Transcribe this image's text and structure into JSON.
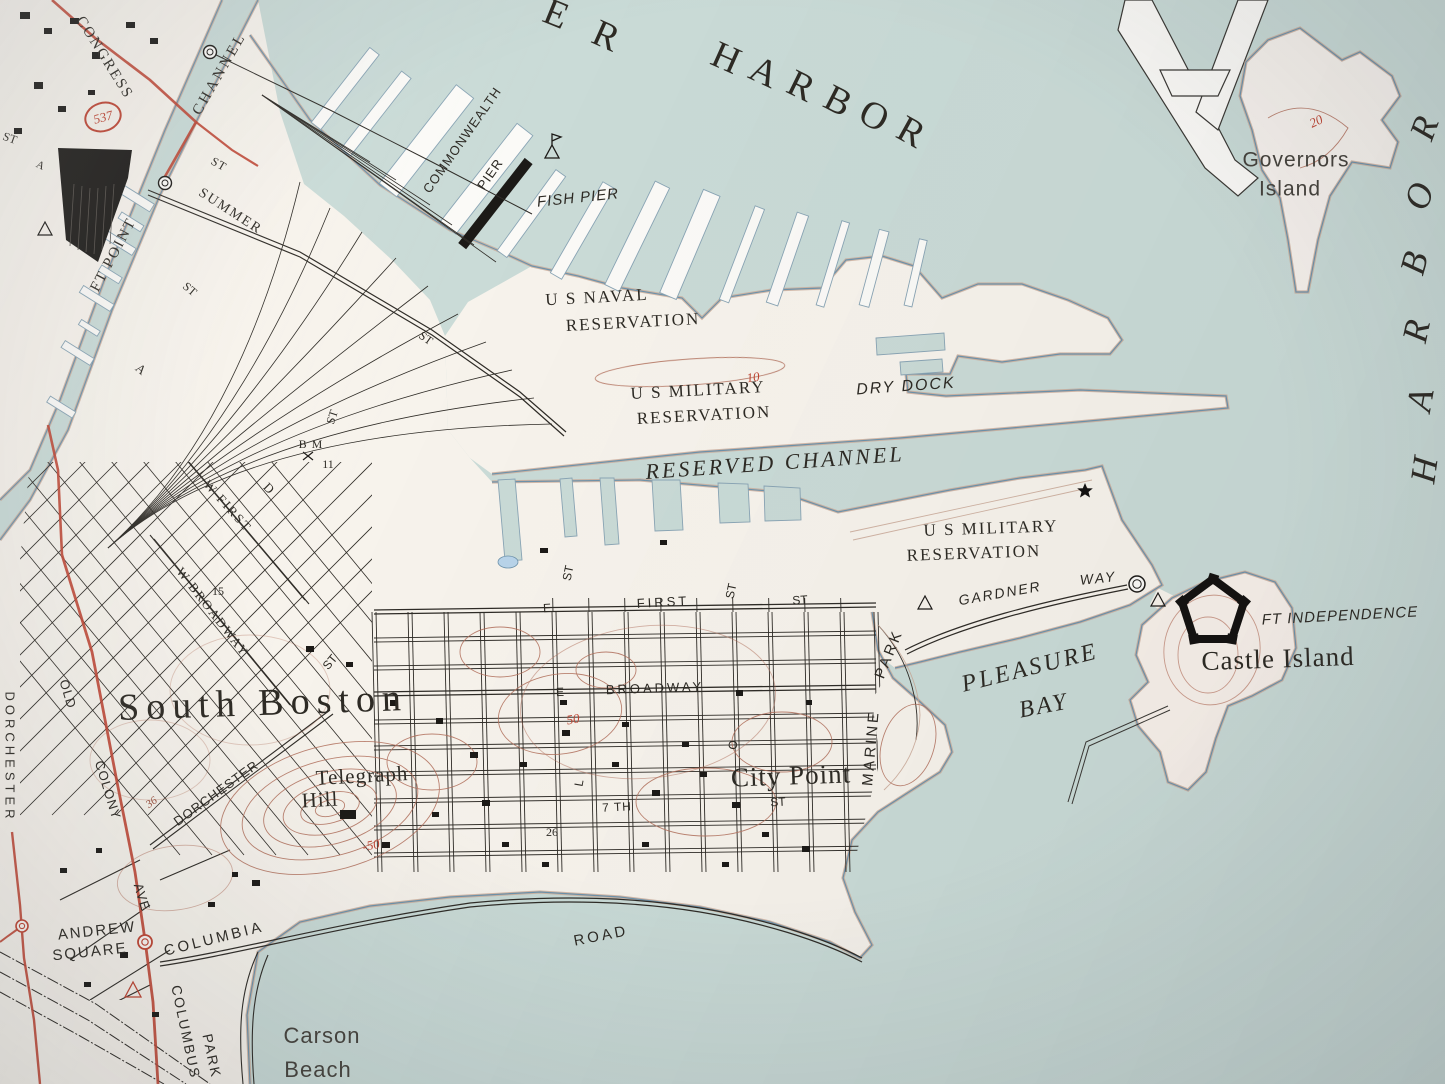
{
  "map": {
    "colors": {
      "water": "#cadbd7",
      "land": "#f7f3ec",
      "pier": "#fbfaf7",
      "road_red": "#bf4533",
      "contour": "#b2705c",
      "shore_blue": "#6f93ab",
      "shore_tan": "#cbab99",
      "ink": "#2f2c27"
    },
    "labels": [
      {
        "t": "E",
        "x": 556,
        "y": 14,
        "r": 22,
        "c": "serif",
        "s": 38,
        "ls": 0,
        "n": "label-harbor-arc"
      },
      {
        "t": "R",
        "x": 606,
        "y": 36,
        "r": 24,
        "c": "serif",
        "s": 38,
        "ls": 0,
        "n": "label-harbor-arc"
      },
      {
        "t": "H",
        "x": 726,
        "y": 58,
        "r": 24,
        "c": "serif",
        "s": 38,
        "ls": 0,
        "n": "label-harbor-arc"
      },
      {
        "t": "A",
        "x": 764,
        "y": 72,
        "r": 25,
        "c": "serif",
        "s": 38,
        "ls": 0,
        "n": "label-harbor-arc"
      },
      {
        "t": "R",
        "x": 801,
        "y": 86,
        "r": 26,
        "c": "serif",
        "s": 38,
        "ls": 0,
        "n": "label-harbor-arc"
      },
      {
        "t": "B",
        "x": 838,
        "y": 101,
        "r": 27,
        "c": "serif",
        "s": 38,
        "ls": 0,
        "n": "label-harbor-arc"
      },
      {
        "t": "O",
        "x": 874,
        "y": 116,
        "r": 28,
        "c": "serif",
        "s": 38,
        "ls": 0,
        "n": "label-harbor-arc"
      },
      {
        "t": "R",
        "x": 911,
        "y": 132,
        "r": 29,
        "c": "serif",
        "s": 38,
        "ls": 0,
        "n": "label-harbor-arc"
      },
      {
        "t": "R",
        "x": 1424,
        "y": 128,
        "r": -70,
        "c": "serif-it",
        "s": 36,
        "ls": 0,
        "n": "label-harbor-vertical"
      },
      {
        "t": "O",
        "x": 1419,
        "y": 196,
        "r": -72,
        "c": "serif-it",
        "s": 36,
        "ls": 0,
        "n": "label-harbor-vertical"
      },
      {
        "t": "B",
        "x": 1414,
        "y": 263,
        "r": -75,
        "c": "serif-it",
        "s": 36,
        "ls": 0,
        "n": "label-harbor-vertical"
      },
      {
        "t": "R",
        "x": 1416,
        "y": 331,
        "r": -78,
        "c": "serif-it",
        "s": 36,
        "ls": 0,
        "n": "label-harbor-vertical"
      },
      {
        "t": "A",
        "x": 1420,
        "y": 400,
        "r": -80,
        "c": "serif-it",
        "s": 36,
        "ls": 0,
        "n": "label-harbor-vertical"
      },
      {
        "t": "H",
        "x": 1424,
        "y": 470,
        "r": -82,
        "c": "serif-it",
        "s": 36,
        "ls": 0,
        "n": "label-harbor-vertical"
      },
      {
        "t": "Governors",
        "x": 1296,
        "y": 160,
        "r": 0,
        "c": "thin",
        "s": 21,
        "ls": 1,
        "n": "label-governors-island"
      },
      {
        "t": "Island",
        "x": 1290,
        "y": 189,
        "r": 0,
        "c": "thin",
        "s": 21,
        "ls": 1,
        "n": "label-governors-island"
      },
      {
        "t": "20",
        "x": 1316,
        "y": 121,
        "r": -25,
        "c": "red",
        "s": 13,
        "ls": 0,
        "n": "contour-label-20"
      },
      {
        "t": "CONGRESS",
        "x": 104,
        "y": 58,
        "r": 58,
        "c": "serif",
        "s": 15,
        "ls": 2,
        "n": "label-congress-st"
      },
      {
        "t": "537",
        "x": 103,
        "y": 117,
        "r": -15,
        "c": "red",
        "s": 13,
        "ls": 0,
        "n": "route-marker-537"
      },
      {
        "t": "FT POINT",
        "x": 114,
        "y": 255,
        "r": -62,
        "c": "serif",
        "s": 15,
        "ls": 2,
        "n": "label-ft-point-channel"
      },
      {
        "t": "CHANNEL",
        "x": 220,
        "y": 74,
        "r": -60,
        "c": "serif",
        "s": 15,
        "ls": 3,
        "n": "label-ft-point-channel"
      },
      {
        "t": "ST",
        "x": 219,
        "y": 164,
        "r": 30,
        "c": "serif",
        "s": 12,
        "ls": 1,
        "n": "label-st"
      },
      {
        "t": "SUMMER",
        "x": 230,
        "y": 212,
        "r": 33,
        "c": "serif",
        "s": 14,
        "ls": 2,
        "n": "label-summer-st"
      },
      {
        "t": "COMMONWEALTH",
        "x": 462,
        "y": 140,
        "r": -55,
        "c": "sans",
        "s": 13,
        "ls": 1,
        "n": "label-commonwealth-pier"
      },
      {
        "t": "PIER",
        "x": 490,
        "y": 174,
        "r": -55,
        "c": "sans",
        "s": 13,
        "ls": 1,
        "n": "label-commonwealth-pier"
      },
      {
        "t": "FISH PIER",
        "x": 578,
        "y": 198,
        "r": -6,
        "c": "sans-it",
        "s": 15,
        "ls": 1,
        "n": "label-fish-pier"
      },
      {
        "t": "U S NAVAL",
        "x": 597,
        "y": 297,
        "r": -3,
        "c": "serif",
        "s": 17,
        "ls": 2,
        "n": "label-us-naval-reservation"
      },
      {
        "t": "RESERVATION",
        "x": 633,
        "y": 322,
        "r": -3,
        "c": "serif",
        "s": 17,
        "ls": 2,
        "n": "label-us-naval-reservation"
      },
      {
        "t": "U S MILITARY",
        "x": 698,
        "y": 390,
        "r": -3,
        "c": "serif",
        "s": 17,
        "ls": 2,
        "n": "label-us-military-reservation-1"
      },
      {
        "t": "RESERVATION",
        "x": 704,
        "y": 415,
        "r": -3,
        "c": "serif",
        "s": 17,
        "ls": 2,
        "n": "label-us-military-reservation-1"
      },
      {
        "t": "DRY DOCK",
        "x": 906,
        "y": 387,
        "r": -4,
        "c": "sans-it",
        "s": 16,
        "ls": 2,
        "n": "label-dry-dock"
      },
      {
        "t": "10",
        "x": 753,
        "y": 377,
        "r": -8,
        "c": "red",
        "s": 13,
        "ls": 0,
        "n": "contour-label-10"
      },
      {
        "t": "RESERVED CHANNEL",
        "x": 775,
        "y": 463,
        "r": -4,
        "c": "serif-it",
        "s": 22,
        "ls": 3,
        "n": "label-reserved-channel"
      },
      {
        "t": "U S MILITARY",
        "x": 991,
        "y": 528,
        "r": -2,
        "c": "serif",
        "s": 17,
        "ls": 2,
        "n": "label-us-military-reservation-2"
      },
      {
        "t": "RESERVATION",
        "x": 974,
        "y": 553,
        "r": -2,
        "c": "serif",
        "s": 17,
        "ls": 2,
        "n": "label-us-military-reservation-2"
      },
      {
        "t": "GARDNER",
        "x": 1000,
        "y": 593,
        "r": -10,
        "c": "sans-it",
        "s": 14,
        "ls": 2,
        "n": "label-gardner-way"
      },
      {
        "t": "WAY",
        "x": 1098,
        "y": 578,
        "r": -6,
        "c": "sans-it",
        "s": 14,
        "ls": 2,
        "n": "label-gardner-way"
      },
      {
        "t": "FT INDEPENDENCE",
        "x": 1340,
        "y": 616,
        "r": -3,
        "c": "sans-it",
        "s": 15,
        "ls": 1,
        "n": "label-ft-independence"
      },
      {
        "t": "Castle Island",
        "x": 1278,
        "y": 659,
        "r": -2,
        "c": "serif",
        "s": 27,
        "ls": 1,
        "n": "label-castle-island"
      },
      {
        "t": "PLEASURE",
        "x": 1030,
        "y": 668,
        "r": -14,
        "c": "serif-it",
        "s": 24,
        "ls": 3,
        "n": "label-pleasure-bay"
      },
      {
        "t": "BAY",
        "x": 1044,
        "y": 706,
        "r": -11,
        "c": "serif-it",
        "s": 24,
        "ls": 3,
        "n": "label-pleasure-bay"
      },
      {
        "t": "South Boston",
        "x": 263,
        "y": 703,
        "r": -2,
        "c": "serif",
        "s": 38,
        "ls": 7,
        "n": "label-south-boston"
      },
      {
        "t": "E",
        "x": 547,
        "y": 608,
        "r": -3,
        "c": "sans",
        "s": 12,
        "ls": 0,
        "n": "label-e-first-st"
      },
      {
        "t": "FIRST",
        "x": 663,
        "y": 602,
        "r": -3,
        "c": "sans",
        "s": 13,
        "ls": 3,
        "n": "label-e-first-st"
      },
      {
        "t": "ST",
        "x": 731,
        "y": 591,
        "r": -78,
        "c": "sans",
        "s": 12,
        "ls": 0,
        "n": "label-st"
      },
      {
        "t": "ST",
        "x": 800,
        "y": 600,
        "r": -4,
        "c": "sans",
        "s": 12,
        "ls": 0,
        "n": "label-st"
      },
      {
        "t": "ST",
        "x": 568,
        "y": 573,
        "r": -78,
        "c": "sans",
        "s": 12,
        "ls": 0,
        "n": "label-st"
      },
      {
        "t": "ST",
        "x": 330,
        "y": 662,
        "r": -50,
        "c": "sans",
        "s": 12,
        "ls": 0,
        "n": "label-st"
      },
      {
        "t": "E",
        "x": 560,
        "y": 692,
        "r": -2,
        "c": "sans",
        "s": 12,
        "ls": 0,
        "n": "label-e-broadway"
      },
      {
        "t": "BROADWAY",
        "x": 655,
        "y": 688,
        "r": -2,
        "c": "sans",
        "s": 13,
        "ls": 3,
        "n": "label-e-broadway"
      },
      {
        "t": "50",
        "x": 573,
        "y": 719,
        "r": -10,
        "c": "red",
        "s": 13,
        "ls": 0,
        "n": "contour-label-50"
      },
      {
        "t": "MARINE",
        "x": 871,
        "y": 748,
        "r": -85,
        "c": "sans",
        "s": 15,
        "ls": 3,
        "n": "label-marine-park"
      },
      {
        "t": "PARK",
        "x": 889,
        "y": 654,
        "r": -68,
        "c": "sans",
        "s": 15,
        "ls": 3,
        "n": "label-marine-park"
      },
      {
        "t": "City Point",
        "x": 791,
        "y": 776,
        "r": -2,
        "c": "serif",
        "s": 27,
        "ls": 1,
        "n": "label-city-point"
      },
      {
        "t": "O",
        "x": 733,
        "y": 745,
        "r": -80,
        "c": "sans",
        "s": 12,
        "ls": 0,
        "n": "label-o-st"
      },
      {
        "t": "L",
        "x": 579,
        "y": 783,
        "r": -80,
        "c": "sans",
        "s": 12,
        "ls": 0,
        "n": "label-l-st"
      },
      {
        "t": "7 TH",
        "x": 617,
        "y": 807,
        "r": -3,
        "c": "sans",
        "s": 12,
        "ls": 1,
        "n": "label-7th-st"
      },
      {
        "t": "ST",
        "x": 778,
        "y": 802,
        "r": -3,
        "c": "sans",
        "s": 12,
        "ls": 0,
        "n": "label-st"
      },
      {
        "t": "26",
        "x": 552,
        "y": 832,
        "r": 0,
        "c": "serif",
        "s": 12,
        "ls": 0,
        "n": "label-26"
      },
      {
        "t": "Telegraph",
        "x": 362,
        "y": 776,
        "r": -3,
        "c": "serif",
        "s": 21,
        "ls": 1,
        "n": "label-telegraph-hill"
      },
      {
        "t": "Hill",
        "x": 320,
        "y": 800,
        "r": -3,
        "c": "serif",
        "s": 21,
        "ls": 1,
        "n": "label-telegraph-hill"
      },
      {
        "t": "-50",
        "x": 371,
        "y": 845,
        "r": -12,
        "c": "red",
        "s": 13,
        "ls": 0,
        "n": "contour-label-50"
      },
      {
        "t": "W FIRST",
        "x": 228,
        "y": 506,
        "r": 48,
        "c": "serif",
        "s": 13,
        "ls": 2,
        "n": "label-w-first-st"
      },
      {
        "t": "W BROADWAY",
        "x": 213,
        "y": 612,
        "r": 52,
        "c": "serif",
        "s": 13,
        "ls": 2,
        "n": "label-w-broadway"
      },
      {
        "t": "D",
        "x": 269,
        "y": 488,
        "r": 45,
        "c": "serif",
        "s": 13,
        "ls": 0,
        "n": "label-d-st"
      },
      {
        "t": "A",
        "x": 141,
        "y": 369,
        "r": 40,
        "c": "serif",
        "s": 13,
        "ls": 0,
        "n": "label-a-st"
      },
      {
        "t": "ST",
        "x": 190,
        "y": 289,
        "r": 40,
        "c": "serif",
        "s": 12,
        "ls": 0,
        "n": "label-st"
      },
      {
        "t": "ST",
        "x": 426,
        "y": 338,
        "r": 35,
        "c": "serif",
        "s": 12,
        "ls": 0,
        "n": "label-st"
      },
      {
        "t": "ST",
        "x": 332,
        "y": 417,
        "r": -72,
        "c": "serif",
        "s": 12,
        "ls": 0,
        "n": "label-st"
      },
      {
        "t": "B M",
        "x": 311,
        "y": 444,
        "r": 0,
        "c": "serif",
        "s": 12,
        "ls": 1,
        "n": "label-benchmark"
      },
      {
        "t": "11",
        "x": 328,
        "y": 464,
        "r": 0,
        "c": "serif",
        "s": 12,
        "ls": 0,
        "n": "label-benchmark-11"
      },
      {
        "t": "15",
        "x": 218,
        "y": 591,
        "r": 0,
        "c": "serif",
        "s": 12,
        "ls": 0,
        "n": "label-15"
      },
      {
        "t": "DORCHESTER",
        "x": 10,
        "y": 757,
        "r": 90,
        "c": "sans",
        "s": 13,
        "ls": 4,
        "n": "label-dorchester-edge"
      },
      {
        "t": "OLD",
        "x": 68,
        "y": 694,
        "r": 73,
        "c": "sans",
        "s": 13,
        "ls": 1,
        "n": "label-old-colony"
      },
      {
        "t": "COLONY",
        "x": 108,
        "y": 790,
        "r": 73,
        "c": "sans",
        "s": 13,
        "ls": 1,
        "n": "label-old-colony"
      },
      {
        "t": "AVE",
        "x": 142,
        "y": 897,
        "r": 73,
        "c": "sans",
        "s": 13,
        "ls": 1,
        "n": "label-ave"
      },
      {
        "t": "DORCHESTER",
        "x": 216,
        "y": 793,
        "r": -36,
        "c": "sans",
        "s": 13,
        "ls": 1,
        "n": "label-dorchester-st"
      },
      {
        "t": "36",
        "x": 152,
        "y": 803,
        "r": -35,
        "c": "contour-red",
        "s": 11,
        "ls": 0,
        "n": "label-36"
      },
      {
        "t": "ANDREW",
        "x": 97,
        "y": 931,
        "r": -6,
        "c": "sans",
        "s": 15,
        "ls": 2,
        "n": "label-andrew-square"
      },
      {
        "t": "SQUARE",
        "x": 90,
        "y": 952,
        "r": -6,
        "c": "sans",
        "s": 15,
        "ls": 2,
        "n": "label-andrew-square"
      },
      {
        "t": "COLUMBIA",
        "x": 214,
        "y": 939,
        "r": -14,
        "c": "sans",
        "s": 15,
        "ls": 3,
        "n": "label-columbia-road"
      },
      {
        "t": "ROAD",
        "x": 601,
        "y": 936,
        "r": -11,
        "c": "sans",
        "s": 15,
        "ls": 3,
        "n": "label-columbia-road"
      },
      {
        "t": "COLUMBUS",
        "x": 186,
        "y": 1032,
        "r": 78,
        "c": "sans",
        "s": 14,
        "ls": 2,
        "n": "label-columbus-park"
      },
      {
        "t": "PARK",
        "x": 212,
        "y": 1056,
        "r": 78,
        "c": "sans",
        "s": 14,
        "ls": 2,
        "n": "label-columbus-park"
      },
      {
        "t": "Carson",
        "x": 322,
        "y": 1036,
        "r": 0,
        "c": "thin",
        "s": 22,
        "ls": 1,
        "n": "label-carson-beach"
      },
      {
        "t": "Beach",
        "x": 318,
        "y": 1070,
        "r": 0,
        "c": "thin",
        "s": 22,
        "ls": 1,
        "n": "label-carson-beach"
      },
      {
        "t": "ST",
        "x": 10,
        "y": 138,
        "r": 20,
        "c": "serif",
        "s": 12,
        "ls": 0,
        "n": "label-st"
      },
      {
        "t": "A",
        "x": 40,
        "y": 166,
        "r": 25,
        "c": "serif",
        "s": 11,
        "ls": 0,
        "n": "label-a"
      }
    ]
  }
}
